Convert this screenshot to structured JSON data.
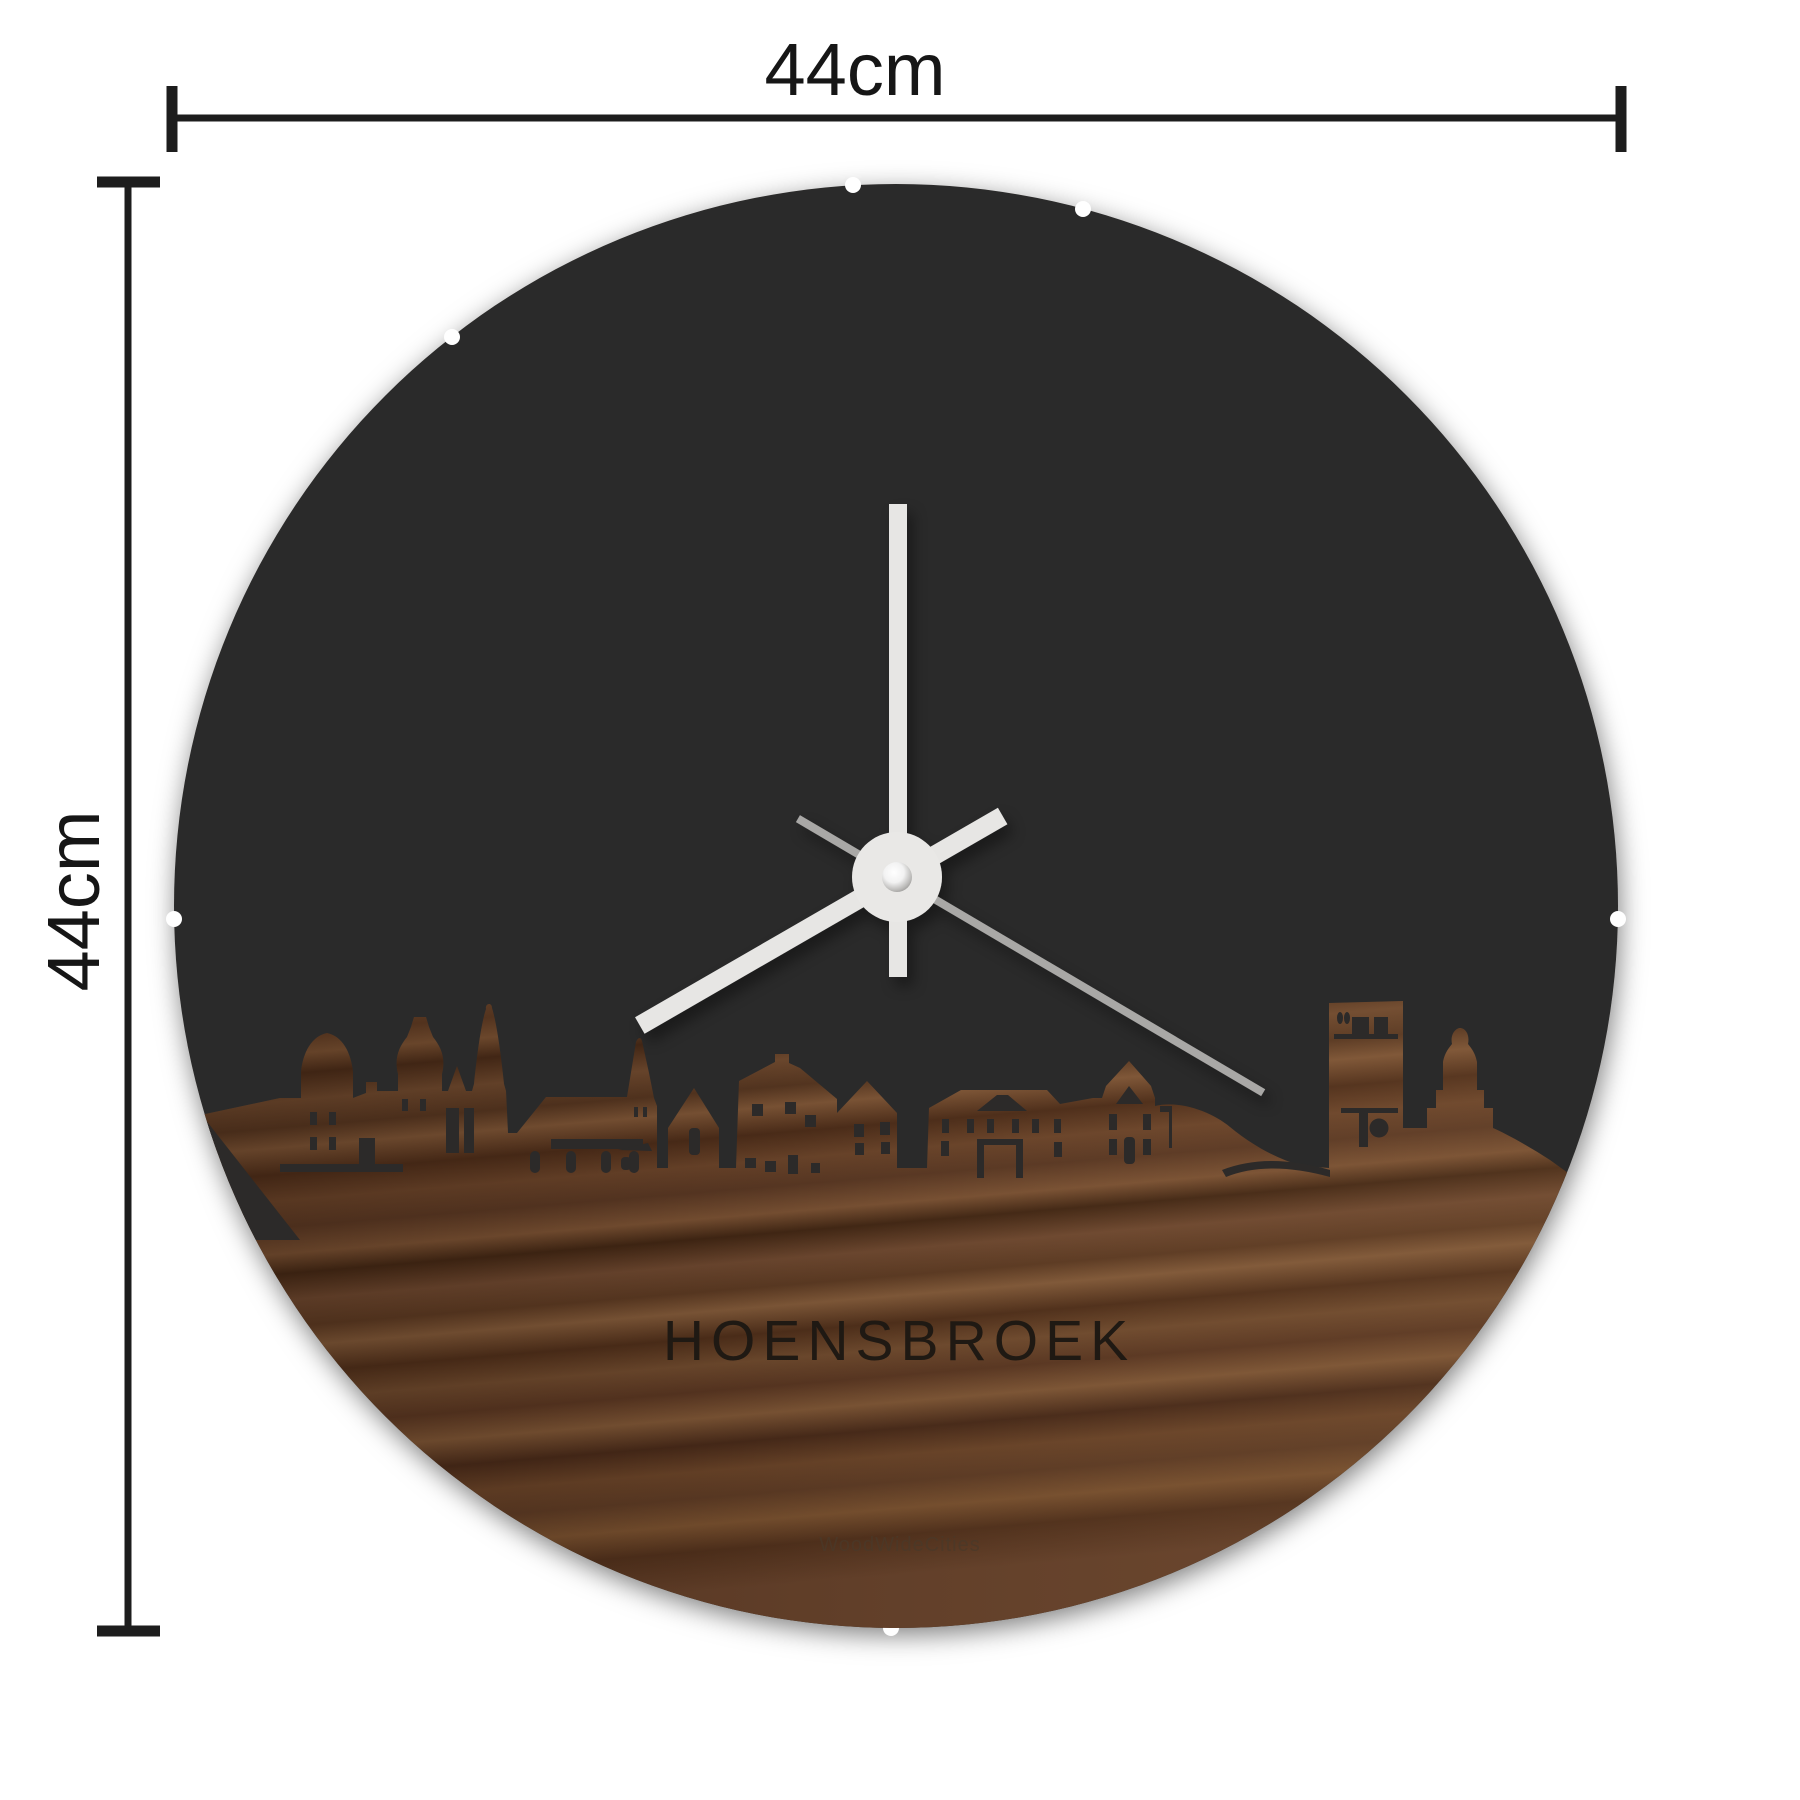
{
  "diagram": {
    "type": "product-dimension-diagram",
    "product": "round wall clock with city skyline in walnut wood",
    "dimensions": {
      "width_label": "44cm",
      "height_label": "44cm"
    },
    "clock": {
      "city_label": "HOENSBROEK",
      "watermark": "WoodWideCities",
      "time_shown": "08:00:20",
      "hands": {
        "minute_angle_deg": 0,
        "hour_angle_deg": 240,
        "second_angle_deg": 120
      }
    },
    "colors": {
      "background": "#ffffff",
      "dimension": "#1d1d1d",
      "disc": "#2c2a29",
      "hand_light": "#e7e6e4",
      "hand_gray": "#a9a8a6",
      "wood_dark": "#3f2513",
      "wood_mid": "#5d3a23",
      "wood_light": "#815a3a",
      "city_text": "#1f1913"
    }
  }
}
